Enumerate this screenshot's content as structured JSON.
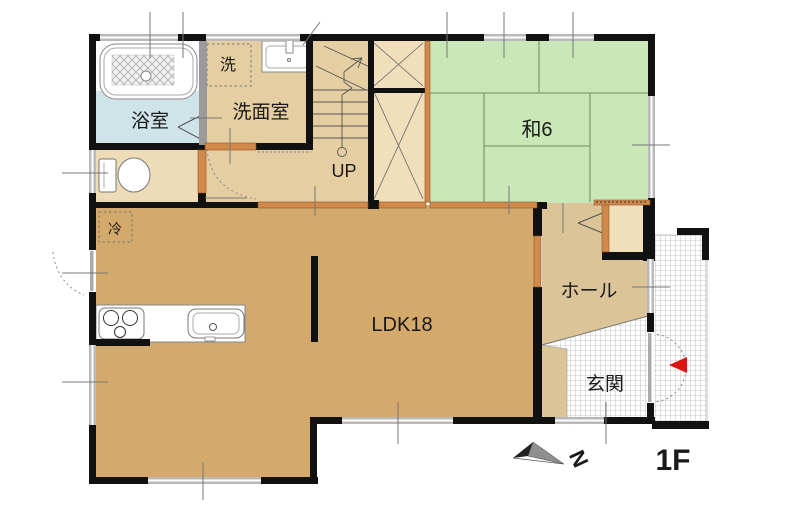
{
  "plan": {
    "floor_label": "1F",
    "compass_north": "N",
    "labels": {
      "bathroom": "浴室",
      "washroom": "洗面室",
      "laundry": "洗",
      "stairs_up": "UP",
      "japanese_room": "和6",
      "refrigerator": "冷",
      "ldk": "LDK18",
      "hall": "ホール",
      "entrance": "玄関"
    },
    "colors": {
      "wall": "#111111",
      "ldk_floor": "#d3a96c",
      "corridor_floor": "#e5cfa2",
      "toilet_floor": "#eedcb8",
      "hall_floor": "#dcc499",
      "closet_floor": "#f0dfba",
      "tatami_green": "#c9e7b7",
      "bathroom_blue": "#cfe4e9",
      "door_orange": "#d28a4c",
      "window_gray": "#b9b9b9",
      "entrance_marker_red": "#dd1111"
    }
  }
}
